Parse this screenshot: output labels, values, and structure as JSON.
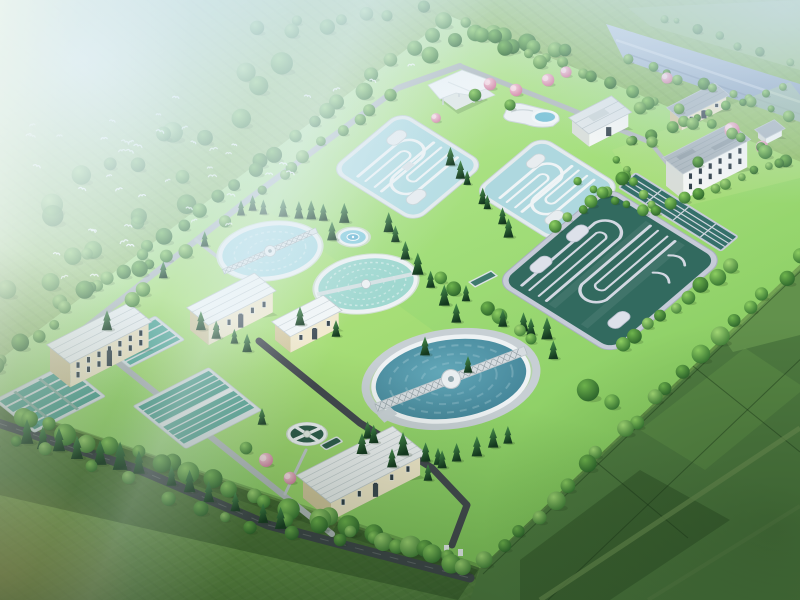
{
  "scene": {
    "type": "3d-aerial-architectural-rendering",
    "subject": "wastewater treatment plant",
    "viewpoint": "high oblique bird's-eye view",
    "surroundings": [
      "hazy tree-covered land with flying white birds (top-left)",
      "blue-gray river with tree-lined banks (top-right)",
      "patchwork farm fields (bottom and right)",
      "tree belt fencing the rectangular plant site"
    ],
    "counts": {
      "oxidation_ditches": 2,
      "dark_aeration_basin": 1,
      "circular_clarifiers_small": 2,
      "circular_clarifier_large": 1,
      "sludge_thickener": 1,
      "fountain_pond": 1,
      "rectangular_filter_basin_groups": 3,
      "buildings": 9,
      "pink_flowering_trees": 9
    }
  },
  "elements": {
    "aerial-rendering": "Aerial rendering of a wastewater treatment plant",
    "plant-site": "Tree-bordered treatment plant site platform",
    "oxidation-ditch-1": "Oxidation ditch with serpentine channel, light blue water",
    "oxidation-ditch-2": "Second oxidation ditch with serpentine channel",
    "aeration-basin": "Large dark-green aeration basin with serpentine dividers",
    "lane-basins": "Narrow parallel water lanes beside aeration basin",
    "clarifier-1": "Circular clarifier with radial bridge",
    "clarifier-2": "Circular clarifier with ripple rings",
    "secondary-clarifier-large": "Large circular clarifier with truss bridge",
    "fountain-pond": "Small round landscape fountain pond",
    "sludge-thickener": "Small dark round thickener tank with cross walkway",
    "filter-basins-a": "Rectangular filter basin block (lower left)",
    "filter-basins-b": "Rectangular filter basin block (upper)",
    "filter-basins-c": "Large multi-lane filter basin block",
    "weir-channel": "Small transfer weir channel",
    "admin-building": "Two-storey cream administration building",
    "workshop-building": "Cream workshop building",
    "dosing-building": "Small cream dosing building",
    "blower-building": "Cream blower house with large white roof",
    "office-building": "White multi-storey office building",
    "gatehouse": "Cream gatehouse with gray roof",
    "substation-building": "White flat-roof substation",
    "utility-shed": "Small white utility shed",
    "pavilion": "Modern white canopy pavilion",
    "pump-station": "Curved white pump station with pool",
    "river": "Blue-gray river with tree-lined banks",
    "farm-fields": "Green farm field patchwork",
    "bird-flock": "Flock of white birds over misty trees",
    "tree-layer": "Trees and hedge belts",
    "roads": "Dark asphalt and light concrete roads"
  },
  "palette": {
    "grassOuter": "#8cbb60",
    "platformGrassLight": "#bce892",
    "platformGrassMid": "#95d768",
    "platformGrassDeep": "#7cc355",
    "fieldDark": "#4e7a40",
    "ditchWater": "#b5dde3",
    "basinDarkWater": "#326a5f",
    "basinWall": "#c6cbd8",
    "clarifier1Water": "#b0dde4",
    "clarifier2Water": "#a0d8d0",
    "bigClarifierWater": "#4b8da0",
    "filterWater": "#55a698",
    "thickenerWater": "#2f5c4c",
    "fountainWater": "#8ecfdf",
    "wallWhite": "#eef2f4",
    "bldgCream": "#f2e9cc",
    "bldgCreamShade": "#d6c9a0",
    "roofWhite": "#f3f6f7",
    "roofGray": "#aeb9c0",
    "windowDark": "#2e3c46",
    "roadDark": "#3e444b",
    "pathLight": "#b6bdc1",
    "riverBlue": "#a5b7cc",
    "treeGreen": "#2f6e2e",
    "coniferGreen": "#1c4f2e",
    "pinkBlossom": "#e3a2bd",
    "birdWhite": "#ffffff"
  }
}
